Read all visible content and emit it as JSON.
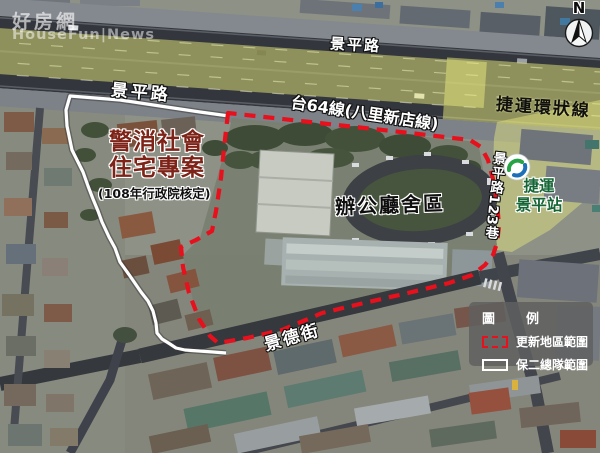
{
  "watermark": {
    "line1": "好房網",
    "line2": "HouseFun|News"
  },
  "compass": {
    "label": "N"
  },
  "roads": {
    "jingping_left": "景平路",
    "jingping_right": "景平路",
    "tai64": "台64線(八里新店線)",
    "jingde": "景德街",
    "lane123": "景平路123巷"
  },
  "metro": {
    "circular_line": "捷運環狀線",
    "station_line1": "捷運",
    "station_line2": "景平站"
  },
  "areas": {
    "housing_title_line1": "警消社會",
    "housing_title_line2": "住宅專案",
    "housing_subtitle": "(108年行政院核定)",
    "office": "辦公廳舍區"
  },
  "legend": {
    "title": "圖　例",
    "items": [
      {
        "label": "更新地區範圍",
        "style": "red-dashed"
      },
      {
        "label": "保二總隊範圍",
        "style": "white-solid"
      }
    ]
  },
  "colors": {
    "update_area_boundary": "#e8101c",
    "police_area_boundary": "#ffffff",
    "metro_highlight": "#ecec7e",
    "housing_text": "#7d2318",
    "station_text": "#156535"
  }
}
